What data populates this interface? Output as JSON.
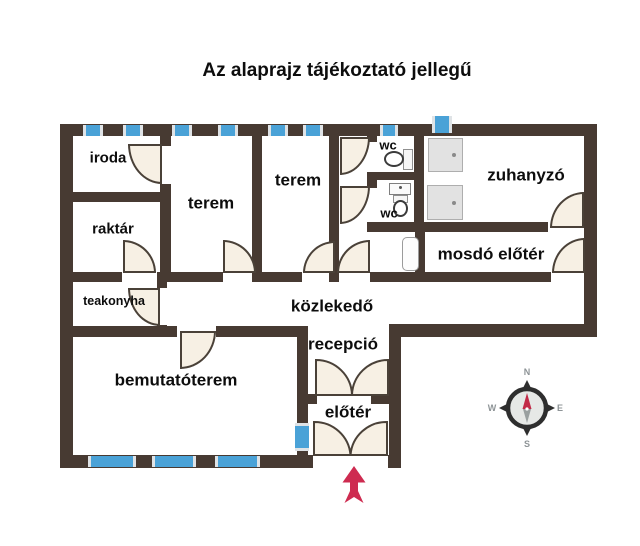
{
  "title": "Az alaprajz tájékoztató jellegű",
  "rooms": [
    {
      "id": "iroda",
      "label": "iroda"
    },
    {
      "id": "terem-1",
      "label": "terem"
    },
    {
      "id": "terem-2",
      "label": "terem"
    },
    {
      "id": "wc-1",
      "label": "wc"
    },
    {
      "id": "wc-2",
      "label": "wc"
    },
    {
      "id": "zuhanyzo",
      "label": "zuhanyzó"
    },
    {
      "id": "raktar",
      "label": "raktár"
    },
    {
      "id": "mosdo-eloter",
      "label": "mosdó előtér"
    },
    {
      "id": "teakonyha",
      "label": "teakonyha"
    },
    {
      "id": "kozlekedo",
      "label": "közlekedő"
    },
    {
      "id": "recepcio",
      "label": "recepció"
    },
    {
      "id": "bemutatoterem",
      "label": "bemutatóterem"
    },
    {
      "id": "eloter",
      "label": "előtér"
    }
  ],
  "compass": {
    "north": "N",
    "east": "E",
    "south": "S",
    "west": "W"
  },
  "colors": {
    "wall": "#473a32",
    "window_blue": "#4aa2d7",
    "door_fill": "#f7f0e4",
    "entrance_arrow_red": "#ce2b50",
    "compass_needle_red": "#c22a48",
    "text": "#0d0d0d"
  },
  "icons": {
    "entrance_arrow": "up-arrow",
    "compass": "compass-rose",
    "fixtures": [
      "toilet",
      "washbasin",
      "shower-tray",
      "double-door",
      "door",
      "window"
    ]
  }
}
